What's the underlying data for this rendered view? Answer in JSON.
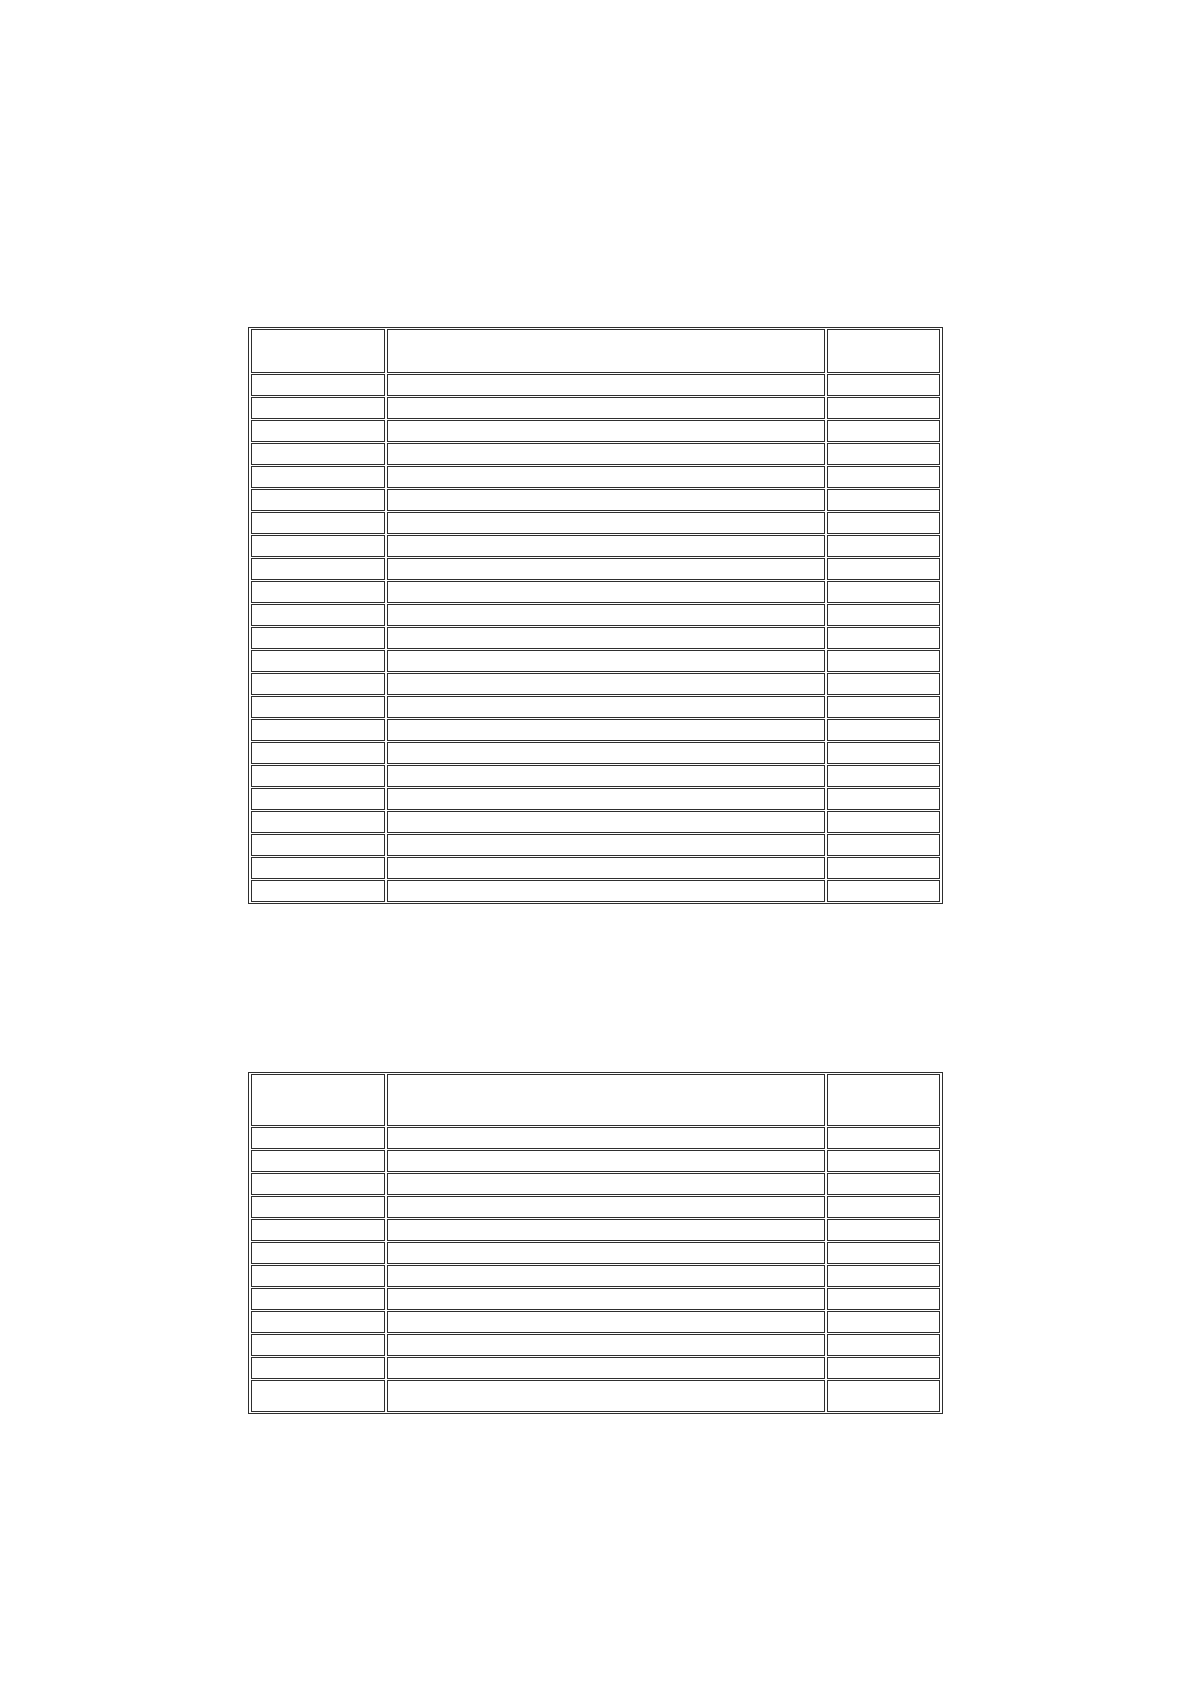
{
  "page": {
    "background_color": "#ffffff",
    "width_px": 1196,
    "height_px": 1692,
    "visible_text": "",
    "description": "blank document page containing two empty ruled tables"
  },
  "border_color": "#2e2e2e",
  "cell_background": "#ffffff",
  "tables": [
    {
      "name": "upper-table",
      "left": 248,
      "top": 327,
      "column_widths": [
        134,
        438,
        113
      ],
      "rows": [
        {
          "kind": "header",
          "height": 44,
          "cells": [
            "",
            "",
            ""
          ]
        },
        {
          "kind": "body",
          "height": 22,
          "cells": [
            "",
            "",
            ""
          ]
        },
        {
          "kind": "body",
          "height": 22,
          "cells": [
            "",
            "",
            ""
          ]
        },
        {
          "kind": "body",
          "height": 22,
          "cells": [
            "",
            "",
            ""
          ]
        },
        {
          "kind": "body",
          "height": 22,
          "cells": [
            "",
            "",
            ""
          ]
        },
        {
          "kind": "body",
          "height": 22,
          "cells": [
            "",
            "",
            ""
          ]
        },
        {
          "kind": "body",
          "height": 22,
          "cells": [
            "",
            "",
            ""
          ]
        },
        {
          "kind": "body",
          "height": 22,
          "cells": [
            "",
            "",
            ""
          ]
        },
        {
          "kind": "body",
          "height": 22,
          "cells": [
            "",
            "",
            ""
          ]
        },
        {
          "kind": "body",
          "height": 22,
          "cells": [
            "",
            "",
            ""
          ]
        },
        {
          "kind": "body",
          "height": 22,
          "cells": [
            "",
            "",
            ""
          ]
        },
        {
          "kind": "body",
          "height": 22,
          "cells": [
            "",
            "",
            ""
          ]
        },
        {
          "kind": "body",
          "height": 22,
          "cells": [
            "",
            "",
            ""
          ]
        },
        {
          "kind": "body",
          "height": 22,
          "cells": [
            "",
            "",
            ""
          ]
        },
        {
          "kind": "body",
          "height": 22,
          "cells": [
            "",
            "",
            ""
          ]
        },
        {
          "kind": "body",
          "height": 22,
          "cells": [
            "",
            "",
            ""
          ]
        },
        {
          "kind": "body",
          "height": 22,
          "cells": [
            "",
            "",
            ""
          ]
        },
        {
          "kind": "body",
          "height": 22,
          "cells": [
            "",
            "",
            ""
          ]
        },
        {
          "kind": "body",
          "height": 22,
          "cells": [
            "",
            "",
            ""
          ]
        },
        {
          "kind": "body",
          "height": 22,
          "cells": [
            "",
            "",
            ""
          ]
        },
        {
          "kind": "body",
          "height": 22,
          "cells": [
            "",
            "",
            ""
          ]
        },
        {
          "kind": "body",
          "height": 22,
          "cells": [
            "",
            "",
            ""
          ]
        },
        {
          "kind": "body",
          "height": 22,
          "cells": [
            "",
            "",
            ""
          ]
        },
        {
          "kind": "body",
          "height": 22,
          "cells": [
            "",
            "",
            ""
          ]
        }
      ]
    },
    {
      "name": "lower-table",
      "left": 248,
      "top": 1072,
      "column_widths": [
        134,
        438,
        113
      ],
      "rows": [
        {
          "kind": "header",
          "height": 52,
          "cells": [
            "",
            "",
            ""
          ]
        },
        {
          "kind": "body",
          "height": 22,
          "cells": [
            "",
            "",
            ""
          ]
        },
        {
          "kind": "body",
          "height": 22,
          "cells": [
            "",
            "",
            ""
          ]
        },
        {
          "kind": "body",
          "height": 22,
          "cells": [
            "",
            "",
            ""
          ]
        },
        {
          "kind": "body",
          "height": 22,
          "cells": [
            "",
            "",
            ""
          ]
        },
        {
          "kind": "body",
          "height": 22,
          "cells": [
            "",
            "",
            ""
          ]
        },
        {
          "kind": "body",
          "height": 22,
          "cells": [
            "",
            "",
            ""
          ]
        },
        {
          "kind": "body",
          "height": 22,
          "cells": [
            "",
            "",
            ""
          ]
        },
        {
          "kind": "body",
          "height": 22,
          "cells": [
            "",
            "",
            ""
          ]
        },
        {
          "kind": "body",
          "height": 22,
          "cells": [
            "",
            "",
            ""
          ]
        },
        {
          "kind": "body",
          "height": 22,
          "cells": [
            "",
            "",
            ""
          ]
        },
        {
          "kind": "body",
          "height": 22,
          "cells": [
            "",
            "",
            ""
          ]
        },
        {
          "kind": "body",
          "height": 32,
          "cells": [
            "",
            "",
            ""
          ]
        }
      ]
    }
  ]
}
